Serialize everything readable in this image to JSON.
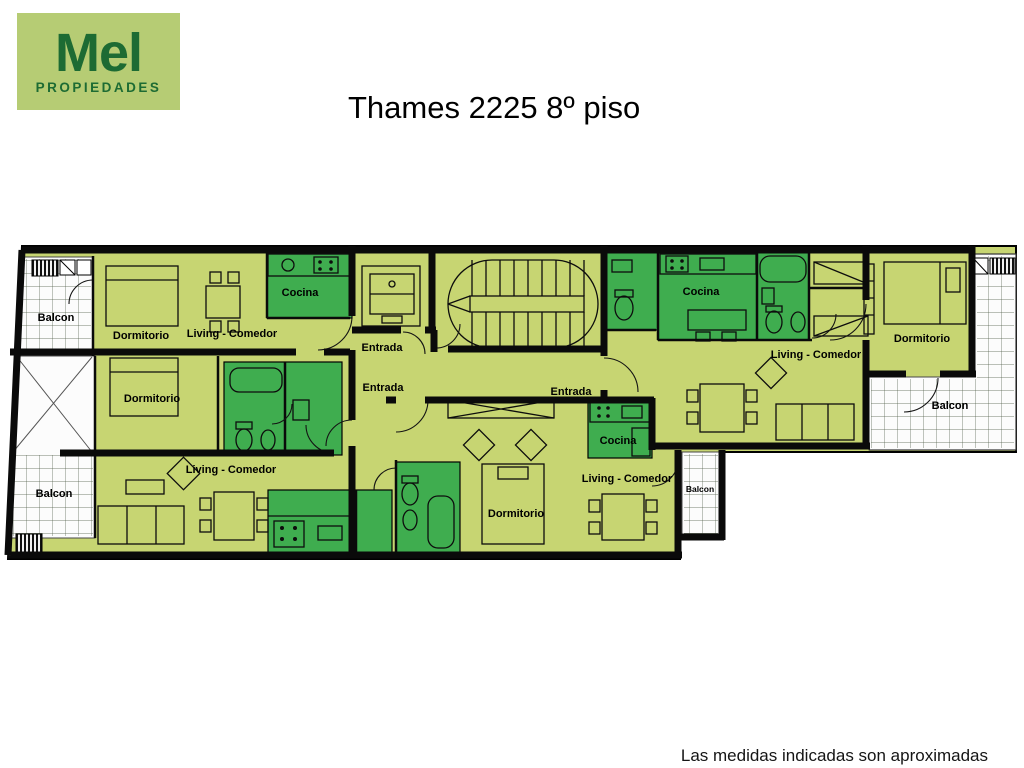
{
  "logo": {
    "brand": "Mel",
    "subtitle": "PROPIEDADES"
  },
  "title": "Thames 2225 8º piso",
  "footer_note": "Las medidas indicadas son aproximadas",
  "plan": {
    "labels": {
      "balcon_top_left": "Balcon",
      "dormitorio_top_left": "Dormitorio",
      "living_top_left": "Living - Comedor",
      "cocina_top_left": "Cocina",
      "dormitorio_mid_left": "Dormitorio",
      "entrada_1": "Entrada",
      "entrada_2": "Entrada",
      "entrada_3": "Entrada",
      "cocina_top_right": "Cocina",
      "living_right": "Living - Comedor",
      "dormitorio_right": "Dormitorio",
      "balcon_right": "Balcon",
      "balcon_mid_left": "Balcon",
      "living_bottom_left": "Living - Comedor",
      "dormitorio_bottom_center": "Dormitorio",
      "cocina_bottom_center": "Cocina",
      "living_bottom_center": "Living - Comedor",
      "balcon_bottom_center": "Balcon"
    }
  },
  "colors": {
    "floor": "#c7d572",
    "accent": "#3fad4f",
    "wall": "#0a0a0a",
    "logo_bg": "#b6cc74",
    "logo_green": "#1d6b33",
    "balcony": "#fcfcfc"
  }
}
